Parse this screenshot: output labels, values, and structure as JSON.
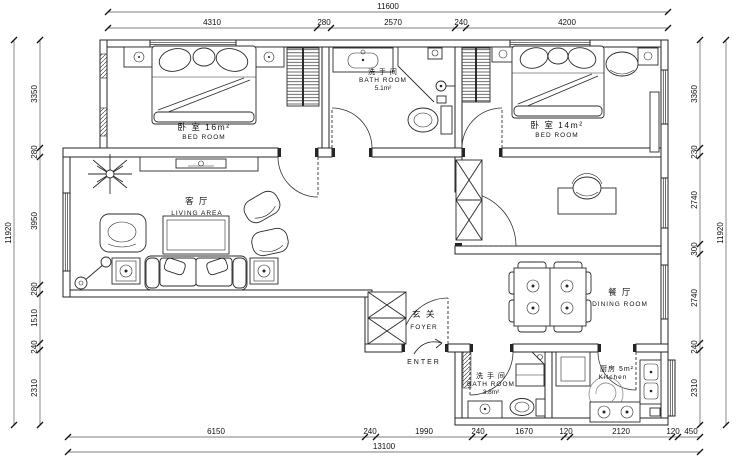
{
  "drawing": {
    "type": "apartment floor plan",
    "colors": {
      "line": "#262626",
      "background": "#ffffff"
    },
    "dims": {
      "top_total": "11600",
      "top": [
        "4310",
        "280",
        "2570",
        "240",
        "4200"
      ],
      "bottom": [
        "6150",
        "240",
        "1990",
        "240",
        "1670",
        "120",
        "2120",
        "120",
        "450"
      ],
      "bottom_total": "13100",
      "left_total": "11920",
      "left": [
        "3350",
        "280",
        "3950",
        "280",
        "1510",
        "240",
        "2310"
      ],
      "right": [
        "3360",
        "230",
        "2740",
        "300",
        "2740",
        "240",
        "2310"
      ],
      "right_total": "11920"
    },
    "rooms": {
      "bedroom1": {
        "cn": "卧 室 16m²",
        "en": "BED ROOM"
      },
      "bathroom1": {
        "cn": "洗 手 间",
        "en": "BATH ROOM",
        "area": "5.1m²"
      },
      "bedroom2": {
        "cn": "卧 室 14m²",
        "en": "BED ROOM"
      },
      "living": {
        "cn": "客 厅",
        "en": "LIVING AREA"
      },
      "dining": {
        "cn": "餐 厅",
        "en": "DINING ROOM"
      },
      "foyer": {
        "cn": "玄 关",
        "en": "FOYER"
      },
      "entry": {
        "label": "ENTER"
      },
      "bathroom2": {
        "cn": "洗 手 间",
        "en": "BATH ROOM",
        "area": "3.8m²"
      },
      "kitchen": {
        "cn": "厨房 5m²",
        "en": "Kitchen"
      }
    }
  }
}
